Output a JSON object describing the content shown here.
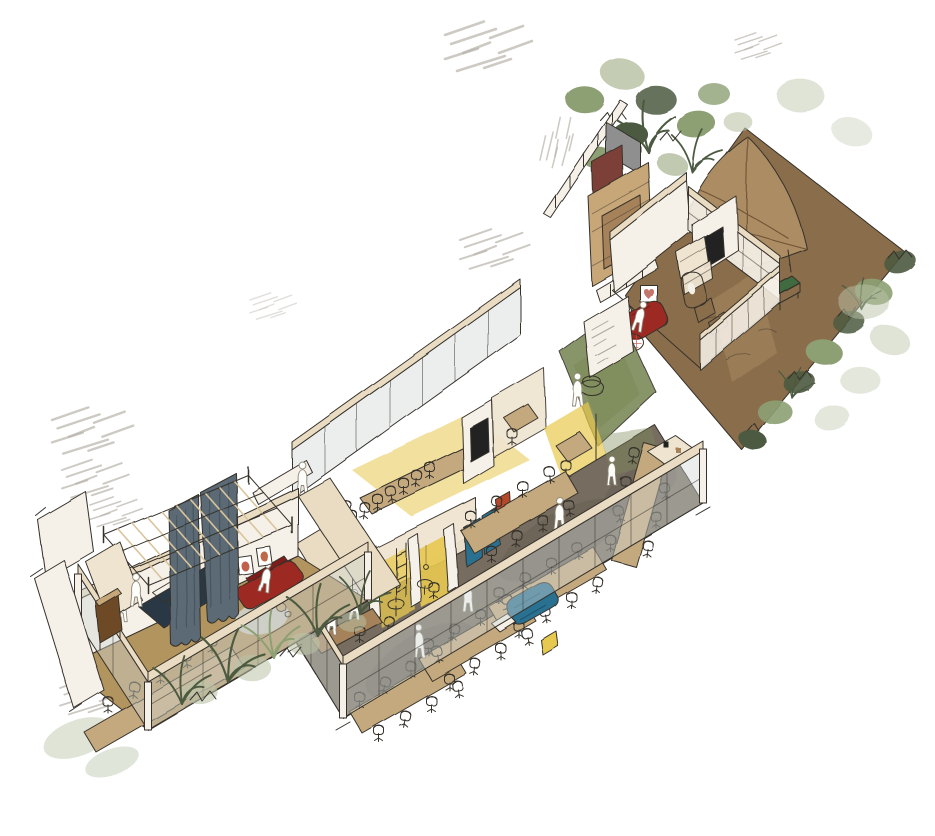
{
  "meta": {
    "title": "Hand-drawn axonometric cutaway sketch of a workplace interior with garden terrace",
    "style": "watercolor architectural illustration",
    "view": "isometric cutaway",
    "canvas": {
      "width": 935,
      "height": 836
    }
  },
  "palette": {
    "ink": "#35302a",
    "wall": "#f6f1e8",
    "cream": "#efe4d0",
    "fascia": "#e9dcc2",
    "wood": "#c7a678",
    "woodD": "#a5825a",
    "floorTan": "#b2945f",
    "floorD": "#766d61",
    "floorD2": "#645b50",
    "green": "#7c8a58",
    "yellow": "#e8c94f",
    "glass": "#cfd6d4",
    "curtain": "#5b6b76",
    "curtainD": "#46555f",
    "navy": "#2c3845",
    "red": "#9c2a22",
    "redD": "#7e1f1a",
    "terra": "#b5472c",
    "rug": "#d0cfc8",
    "teal": "#2c7090",
    "olive": "#6b7045",
    "gbrown": "#8a6d4b",
    "gbrownL": "#9d7f59",
    "canopy": "#ab8c63",
    "canopyD": "#6e5335",
    "leaf": "#8ca073",
    "leafD": "#4c5a40",
    "sage": "#bac3a7",
    "bench": "#3f6b3f",
    "grey": "#8f8f8f",
    "maroon": "#7c4038",
    "chairTan": "#cdb592",
    "chairWhite": "#f2efe6",
    "chairDark": "#3c4043",
    "table": "#c4a97e",
    "hatch": "#b9b4ac",
    "tv": "#232320",
    "brown": "#6e4a28"
  },
  "scene": {
    "rooms": [
      {
        "name": "Garden terrace with canvas canopy",
        "furniture": [
          "stretched canvas canopy",
          "green bench",
          "hedge border",
          "shrub planting"
        ]
      },
      {
        "name": "Service core",
        "furniture": [
          "timber joinery wall",
          "grey partition",
          "maroon partition"
        ]
      },
      {
        "name": "Lounge room",
        "furniture": [
          "wall TV",
          "stepped shelving",
          "sculptural brown chair",
          "red armchair",
          "heart artwork",
          "checkered side table"
        ]
      },
      {
        "name": "Entry hall with green floor",
        "furniture": [
          "red pouf",
          "pin-up wall"
        ]
      },
      {
        "name": "Meeting room",
        "furniture": [
          "long meeting table",
          "dark task chairs",
          "wall screen",
          "yellow floor"
        ]
      },
      {
        "name": "Focus nooks",
        "furniture": [
          "yellow lit niches",
          "bistro tables",
          "blue phone booths",
          "shelf ladder",
          "timber counter"
        ]
      },
      {
        "name": "Dining hall",
        "furniture": [
          "long dining tables",
          "office chairs",
          "blue sofa",
          "sideboard",
          "glazed facade"
        ]
      },
      {
        "name": "Event lounge",
        "furniture": [
          "timber pergola",
          "blue-grey curtains",
          "navy stage table",
          "red sofa",
          "framed artworks",
          "round rug",
          "long table",
          "green chairs"
        ]
      },
      {
        "name": "Planted terrace edge",
        "furniture": [
          "planter with grasses",
          "glazed wall",
          "timber cabinet"
        ]
      }
    ],
    "figures": {
      "count": 12,
      "style": "white sketch silhouettes"
    }
  }
}
